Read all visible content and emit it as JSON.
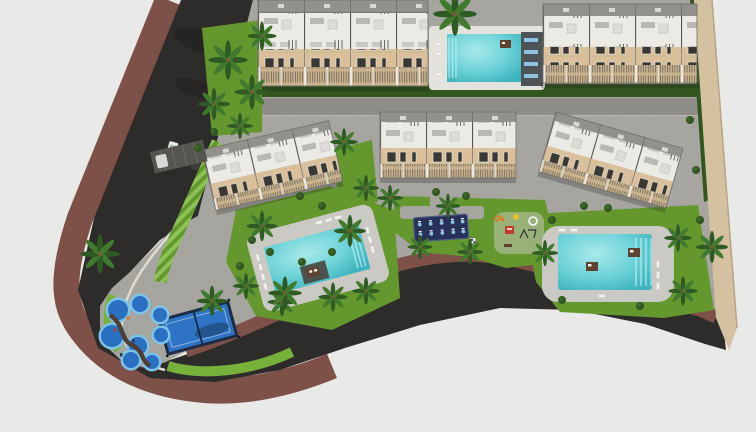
{
  "scene": {
    "title": "Aerial 3D rendering of a residential complex site plan",
    "features": {
      "building_blocks": 5,
      "swimming_pools": 3,
      "kids_splash_pools": 8,
      "padel_courts": 1,
      "outdoor_gyms": 1,
      "playgrounds": 1,
      "palm_trees": 23,
      "carports": 1,
      "vehicles_on_road": 2
    }
  },
  "palette": {
    "bg": "#e9e9e8",
    "asphalt": "#2e2c2b",
    "sidewalk": "#7d5148",
    "curb": "#dedad2",
    "paving": "#a6a5a0",
    "paving_dot": "#91908b",
    "street": "#8e8d88",
    "deck": "#cac9c4",
    "deck_white": "#e3e2dd",
    "lawn": "#64982f",
    "lawn_bright": "#77b13c",
    "lawn_stripe_light": "#8cc257",
    "hedge": "#33551f",
    "tree": "#2f5a24",
    "tree_light": "#417a2e",
    "facade_beige": "#d9c09b",
    "terrace_white": "#eceae5",
    "roof_gray": "#92918c",
    "window_dark": "#3a3833",
    "railing": "#c9b28d",
    "pool_water": "#58c7cd",
    "pool_water_light": "#a5e6e7",
    "pool_deep": "#2fa9b5",
    "court_blue": "#2f74c4",
    "court_frame": "#1d2c44",
    "gym_mat": "#27315a",
    "gym_blue": "#8fc3e0",
    "splash_rim": "#7cc4ea",
    "splash_water": "#2a6fc0",
    "boundary_sand": "#d4c1a1",
    "daybed": "#5d4330",
    "lounger": "#f2f1ec",
    "shadow": "#1c1b1a",
    "play_red": "#c23b2e",
    "play_orange": "#e0761f",
    "play_yellow": "#e8c02c",
    "van_white": "#f0efeb",
    "cart_dark": "#3f3e3c",
    "walk_dark": "#4c4038"
  }
}
